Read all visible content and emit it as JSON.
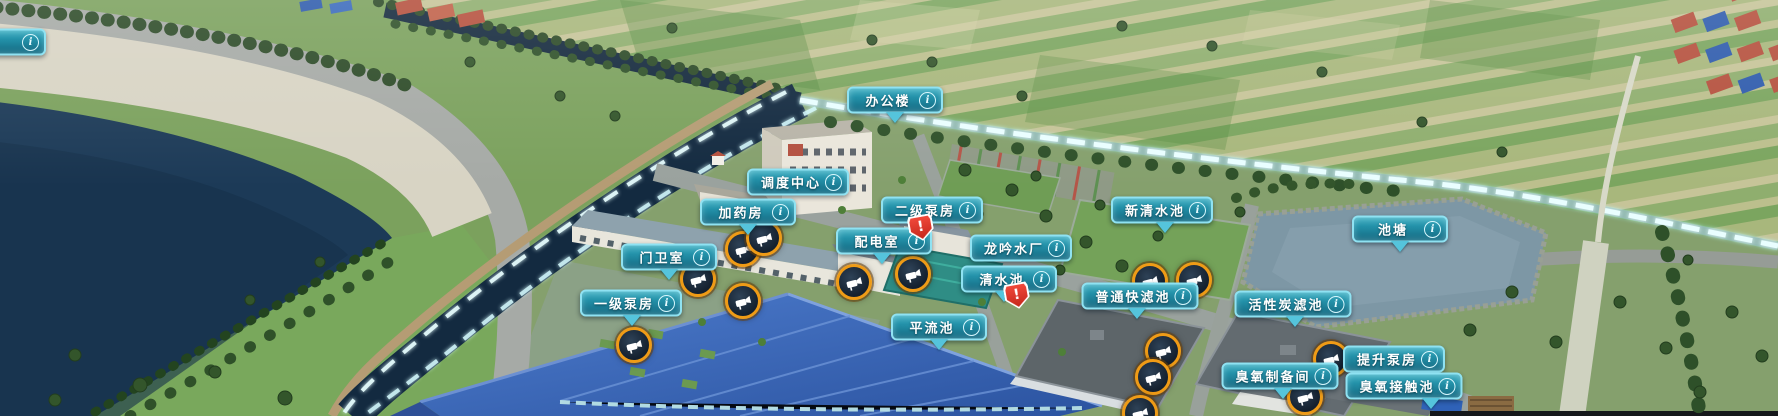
{
  "scene": {
    "type": "3d-digital-twin-map",
    "plant_name": "龙吟水厂"
  },
  "icons": {
    "info": "i",
    "alert": "!"
  },
  "colors": {
    "badge_border": "#8fe2f2",
    "badge_gradient_top": "#47b2c5",
    "badge_gradient_bottom": "#146880",
    "badge_text": "#ffffff",
    "pointer_arrow": "#55c4dc",
    "camera_ring": "#ef9b16",
    "alert_red": "#e6392a",
    "glow_light": "#e7feff",
    "reservoir_water": "#1c3a57",
    "canal_water": "#132a40",
    "blue_roof": "#3a66bb",
    "field_green": "#9db173"
  },
  "labels": [
    {
      "id": "edge-partial",
      "text": "",
      "x": -2,
      "y": 42,
      "arrow": false
    },
    {
      "id": "office-building",
      "text": "办公楼",
      "x": 895,
      "y": 100,
      "arrow": true,
      "dx": 0
    },
    {
      "id": "dispatch-center",
      "text": "调度中心",
      "x": 798,
      "y": 182,
      "arrow": false
    },
    {
      "id": "dosing-room",
      "text": "加药房",
      "x": 748,
      "y": 212,
      "arrow": true,
      "dx": 0
    },
    {
      "id": "secondary-pump-house",
      "text": "二级泵房",
      "x": 932,
      "y": 210,
      "arrow": false
    },
    {
      "id": "power-distribution-room",
      "text": "配电室",
      "x": 884,
      "y": 241,
      "arrow": true,
      "dx": -2
    },
    {
      "id": "guard-room",
      "text": "门卫室",
      "x": 669,
      "y": 257,
      "arrow": true,
      "dx": 0
    },
    {
      "id": "primary-pump-house",
      "text": "一级泵房",
      "x": 631,
      "y": 303,
      "arrow": true,
      "dx": 1
    },
    {
      "id": "longyin-water-plant",
      "text": "龙吟水厂",
      "x": 1021,
      "y": 248,
      "arrow": false
    },
    {
      "id": "clear-water-pool",
      "text": "清水池",
      "x": 1009,
      "y": 279,
      "arrow": true,
      "dx": -5
    },
    {
      "id": "sedimentation-basin",
      "text": "平流池",
      "x": 939,
      "y": 327,
      "arrow": true,
      "dx": 0
    },
    {
      "id": "new-clear-water-pool",
      "text": "新清水池",
      "x": 1162,
      "y": 210,
      "arrow": true,
      "dx": 3
    },
    {
      "id": "pond",
      "text": "池塘",
      "x": 1400,
      "y": 229,
      "arrow": true,
      "dx": 0
    },
    {
      "id": "rapid-sand-filter",
      "text": "普通快滤池",
      "x": 1140,
      "y": 296,
      "arrow": true,
      "dx": -3
    },
    {
      "id": "activated-carbon-filter",
      "text": "活性炭滤池",
      "x": 1293,
      "y": 304,
      "arrow": true,
      "dx": 2
    },
    {
      "id": "lift-pump-house",
      "text": "提升泵房",
      "x": 1394,
      "y": 359,
      "arrow": false
    },
    {
      "id": "ozone-preparation-room",
      "text": "臭氧制备间",
      "x": 1280,
      "y": 376,
      "arrow": true,
      "dx": 3
    },
    {
      "id": "ozone-contact-pool",
      "text": "臭氧接触池",
      "x": 1404,
      "y": 386,
      "arrow": true,
      "dx": 27
    }
  ],
  "cameras": [
    {
      "x": 743,
      "y": 249
    },
    {
      "x": 764,
      "y": 238
    },
    {
      "x": 698,
      "y": 279
    },
    {
      "x": 743,
      "y": 301
    },
    {
      "x": 634,
      "y": 345
    },
    {
      "x": 854,
      "y": 282
    },
    {
      "x": 913,
      "y": 274
    },
    {
      "x": 1150,
      "y": 281
    },
    {
      "x": 1194,
      "y": 280
    },
    {
      "x": 1163,
      "y": 351
    },
    {
      "x": 1153,
      "y": 377
    },
    {
      "x": 1331,
      "y": 359
    },
    {
      "x": 1305,
      "y": 397
    },
    {
      "x": 1140,
      "y": 413
    }
  ],
  "alerts": [
    {
      "x": 921,
      "y": 228
    },
    {
      "x": 1017,
      "y": 296
    }
  ]
}
